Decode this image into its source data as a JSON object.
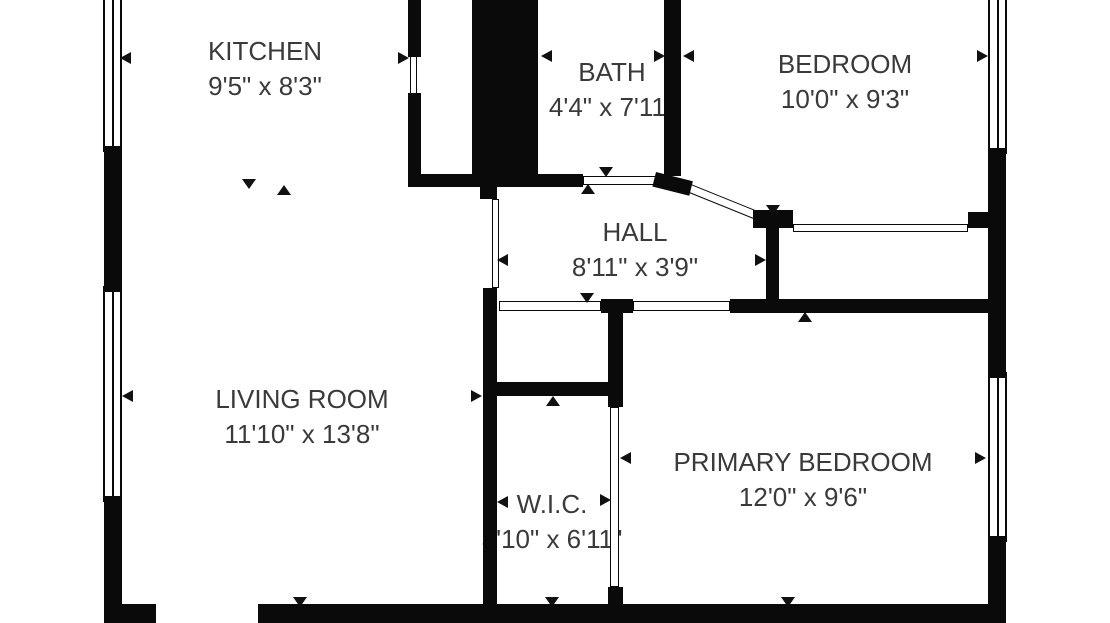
{
  "plan": {
    "title": "apartment-floor-plan",
    "background_color": "#ffffff",
    "wall_color": "#0a0a0a",
    "text_color": "#3a3a3a",
    "rooms": [
      {
        "id": "kitchen",
        "name": "KITCHEN",
        "dimensions": "9'5\" x 8'3\""
      },
      {
        "id": "bath",
        "name": "BATH",
        "dimensions": "4'4\" x 7'11\""
      },
      {
        "id": "bedroom",
        "name": "BEDROOM",
        "dimensions": "10'0\" x 9'3\""
      },
      {
        "id": "hall",
        "name": "HALL",
        "dimensions": "8'11\" x 3'9\""
      },
      {
        "id": "living-room",
        "name": "LIVING ROOM",
        "dimensions": "11'10\" x 13'8\""
      },
      {
        "id": "wic",
        "name": "W.I.C.",
        "dimensions": "3'10\" x 6'11\""
      },
      {
        "id": "primary-bedroom",
        "name": "PRIMARY BEDROOM",
        "dimensions": "12'0\" x 9'6\""
      }
    ]
  }
}
